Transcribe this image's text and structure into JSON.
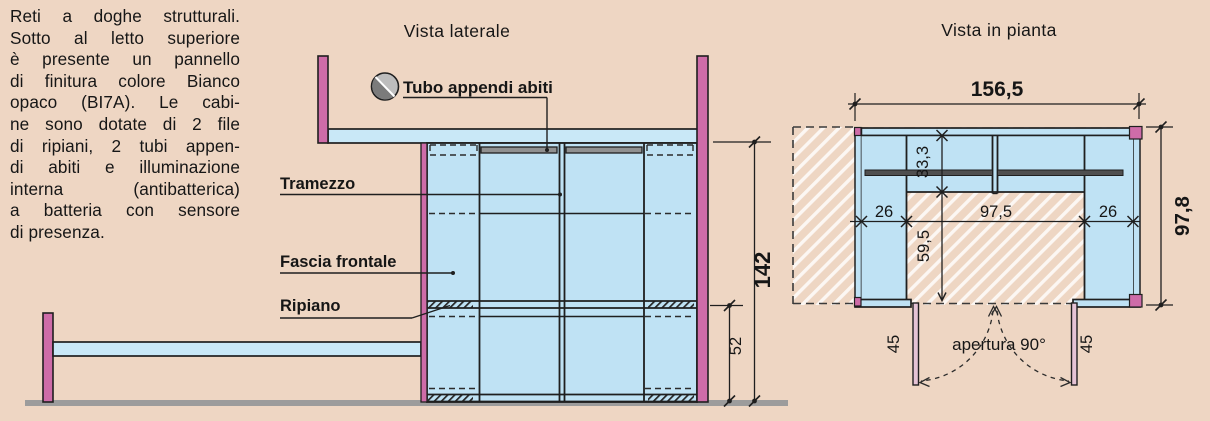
{
  "description": {
    "lines": [
      "Reti a doghe strutturali.",
      "Sotto al letto superiore",
      "è presente un pannello",
      "di finitura colore Bianco",
      "opaco (BI7A). Le cabi-",
      "ne sono dotate di 2 file",
      "di ripiani, 2 tubi appen-",
      "di abiti e illuminazione",
      "interna (antibatterica)",
      "a batteria con sensore",
      "di presenza."
    ]
  },
  "side_view": {
    "title": "Vista laterale",
    "labels": {
      "tube": "Tubo appendi abiti",
      "partition": "Tramezzo",
      "front_band": "Fascia frontale",
      "shelf": "Ripiano"
    },
    "dimensions": {
      "total_height": "142",
      "shelf_height": "52"
    }
  },
  "plan_view": {
    "title": "Vista in pianta",
    "dimensions": {
      "total_width": "156,5",
      "shelf_depth": "33,3",
      "left_column": "26",
      "center_span": "97,5",
      "right_column": "26",
      "front_depth": "59,5",
      "total_depth": "97,8",
      "door_left": "45",
      "door_right": "45"
    },
    "annotation": "apertura 90°"
  },
  "colors": {
    "background": "#eed6c3",
    "panel_blue": "#bfe2f4",
    "frame_pink": "#ce6ca8",
    "door_pink": "#e5c3d5",
    "line": "#1f1f1f",
    "ground_gray": "#9c9c9c",
    "tube_gray": "#909090"
  }
}
